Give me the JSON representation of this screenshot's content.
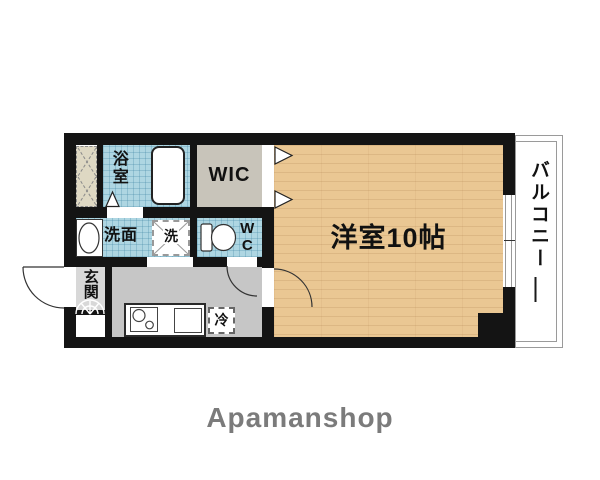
{
  "branding": {
    "logo": "Apamanshop"
  },
  "labels": {
    "bathroom": "浴室",
    "wic": "WIC",
    "washroom": "洗面",
    "washer": "洗",
    "wc": "WC",
    "entrance": "玄関",
    "main_room": "洋室10帖",
    "balcony": "バルコニー",
    "fridge": "冷"
  },
  "colors": {
    "wall": "#141414",
    "wet_room_blue": "#aed6e2",
    "wood_floor": "#eac793",
    "wic_gray": "#c8c4ba",
    "kitchen_gray": "#c6c6c6",
    "entrance_gray": "#d8d8d8",
    "pipe_space_tan": "#ded8c3",
    "logo_gray": "#7b7b7b"
  }
}
